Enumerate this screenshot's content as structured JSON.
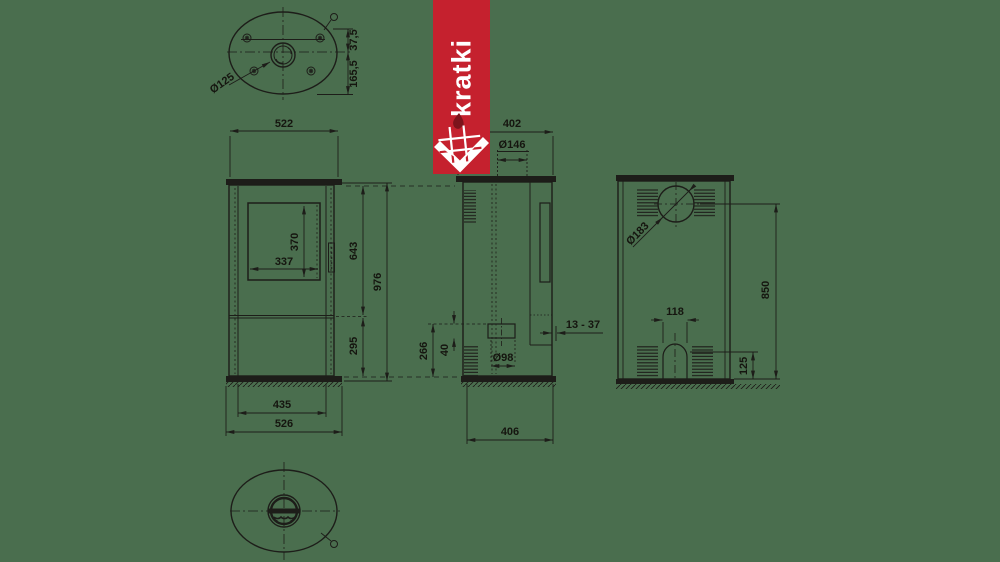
{
  "colors": {
    "background": "#4a6e4e",
    "line": "#1d1d19",
    "dim_text": "#15150f",
    "logo_red": "#c5212e",
    "logo_white": "#ffffff",
    "logo_flame_dark": "#7d141c"
  },
  "logo": {
    "brand": "kratki"
  },
  "views": {
    "top": {
      "flue_diameter": "Ø125",
      "offset_top": "37,5",
      "offset_bottom": "165,5"
    },
    "front": {
      "top_width": "522",
      "glass_width": "337",
      "glass_height": "370",
      "body_height": "643",
      "total_height": "976",
      "base_height": "295",
      "base_inner_width": "435",
      "base_width": "526"
    },
    "side": {
      "top_depth": "402",
      "flue_collar_diameter": "Ø146",
      "rear_gap_range": "13 - 37",
      "inlet_height": "266",
      "inlet_size": "40",
      "inlet_diameter": "Ø98",
      "base_depth": "406"
    },
    "back": {
      "rear_flue_diameter": "Ø183",
      "arch_width": "118",
      "rear_flue_height": "850",
      "arch_height": "125"
    }
  }
}
